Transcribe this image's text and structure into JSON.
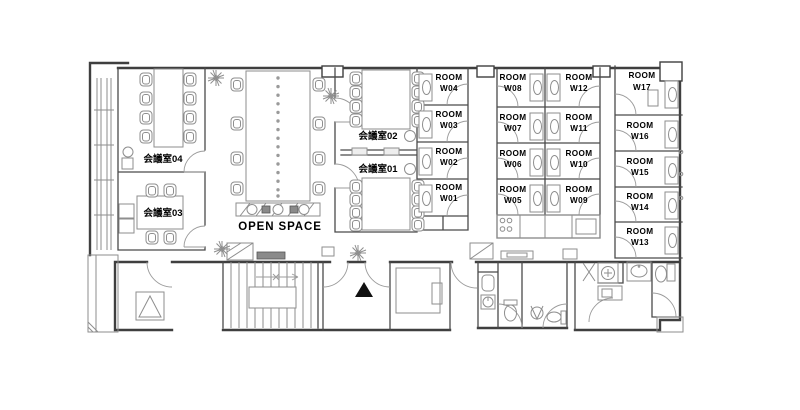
{
  "floorplan": {
    "open_space": {
      "label": "OPEN SPACE"
    },
    "meeting_rooms": [
      {
        "id": "meeting-room-01",
        "label": "会議室01"
      },
      {
        "id": "meeting-room-02",
        "label": "会議室02"
      },
      {
        "id": "meeting-room-03",
        "label": "会議室03"
      },
      {
        "id": "meeting-room-04",
        "label": "会議室04"
      }
    ],
    "private_rooms": [
      {
        "id": "room-w01",
        "line1": "ROOM",
        "line2": "W01"
      },
      {
        "id": "room-w02",
        "line1": "ROOM",
        "line2": "W02"
      },
      {
        "id": "room-w03",
        "line1": "ROOM",
        "line2": "W03"
      },
      {
        "id": "room-w04",
        "line1": "ROOM",
        "line2": "W04"
      },
      {
        "id": "room-w05",
        "line1": "ROOM",
        "line2": "W05"
      },
      {
        "id": "room-w06",
        "line1": "ROOM",
        "line2": "W06"
      },
      {
        "id": "room-w07",
        "line1": "ROOM",
        "line2": "W07"
      },
      {
        "id": "room-w08",
        "line1": "ROOM",
        "line2": "W08"
      },
      {
        "id": "room-w09",
        "line1": "ROOM",
        "line2": "W09"
      },
      {
        "id": "room-w10",
        "line1": "ROOM",
        "line2": "W10"
      },
      {
        "id": "room-w11",
        "line1": "ROOM",
        "line2": "W11"
      },
      {
        "id": "room-w12",
        "line1": "ROOM",
        "line2": "W12"
      },
      {
        "id": "room-w13",
        "line1": "ROOM",
        "line2": "W13"
      },
      {
        "id": "room-w14",
        "line1": "ROOM",
        "line2": "W14"
      },
      {
        "id": "room-w15",
        "line1": "ROOM",
        "line2": "W15"
      },
      {
        "id": "room-w16",
        "line1": "ROOM",
        "line2": "W16"
      },
      {
        "id": "room-w17",
        "line1": "ROOM",
        "line2": "W17"
      }
    ]
  }
}
